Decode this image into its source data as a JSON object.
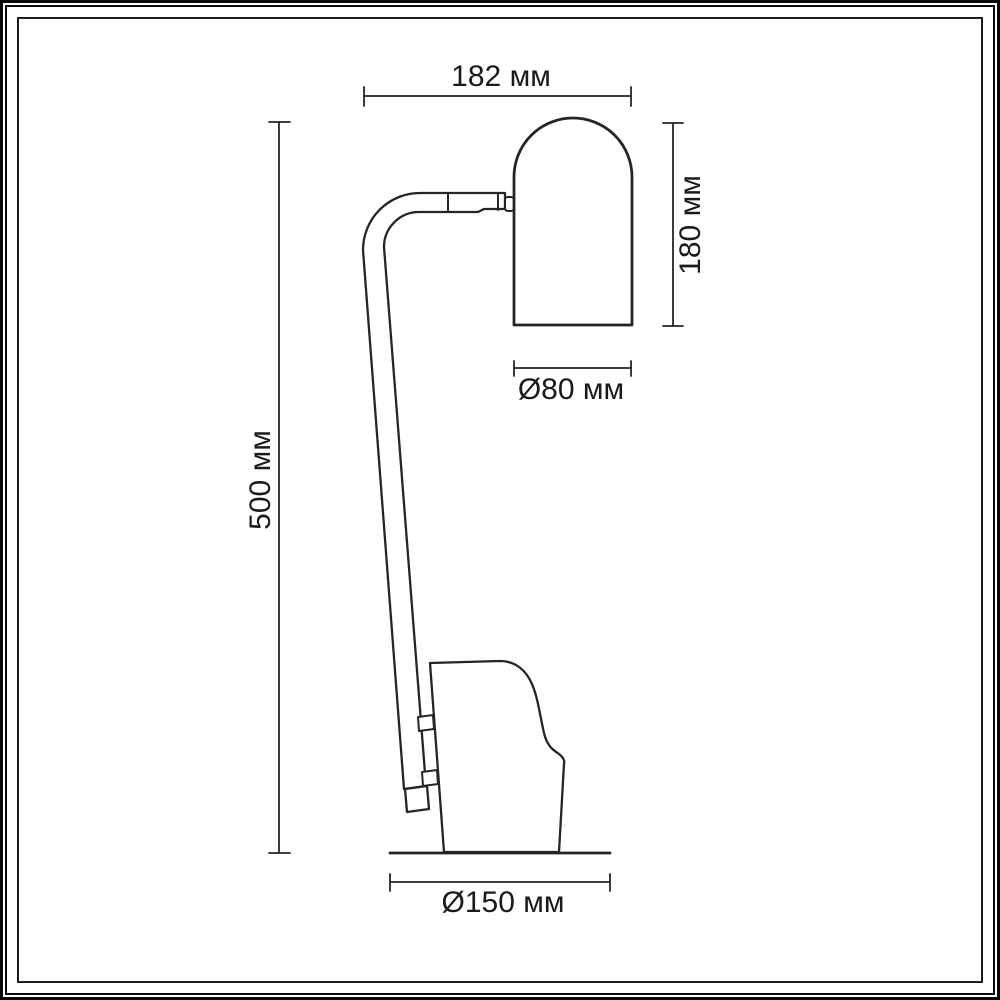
{
  "drawing": {
    "subject": "table-lamp-dimensional-drawing",
    "background_color": "#ffffff",
    "line_color": "#252525",
    "frame_color": "#0a0a0a",
    "unit": "мм",
    "dimensions": [
      {
        "id": "fixture-width",
        "label": "182 мм",
        "value": 182,
        "unit": "мм",
        "orientation": "horizontal"
      },
      {
        "id": "shade-height",
        "label": "180 мм",
        "value": 180,
        "unit": "мм",
        "orientation": "vertical"
      },
      {
        "id": "shade-diameter",
        "label": "Ø80 мм",
        "value": 80,
        "unit": "мм",
        "orientation": "horizontal"
      },
      {
        "id": "total-height",
        "label": "500 мм",
        "value": 500,
        "unit": "мм",
        "orientation": "vertical"
      },
      {
        "id": "base-diameter",
        "label": "Ø150 мм",
        "value": 150,
        "unit": "мм",
        "orientation": "horizontal"
      }
    ]
  }
}
